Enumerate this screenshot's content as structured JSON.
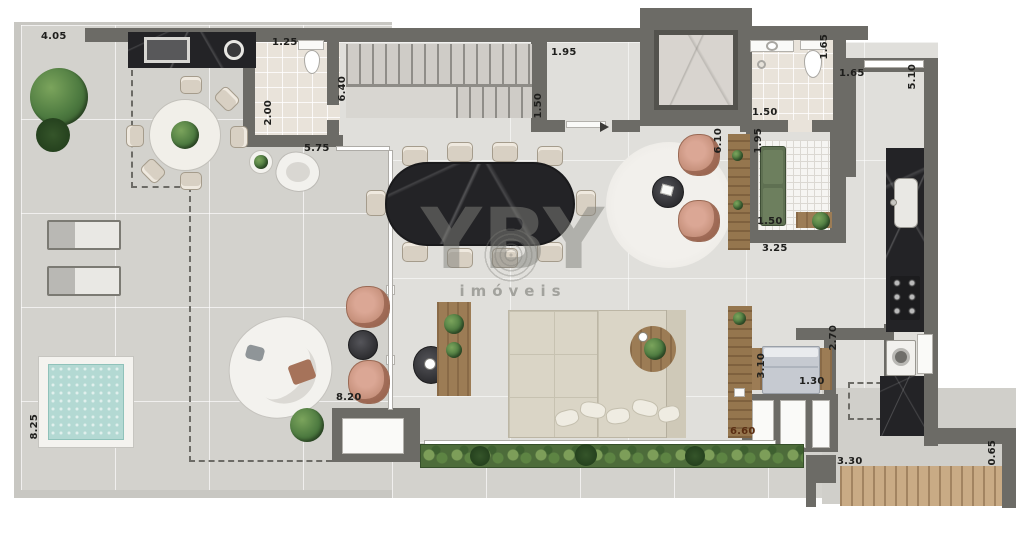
{
  "meta": {
    "type": "apartment-floor-plan"
  },
  "watermark": {
    "brand": "YBY",
    "tagline": "imóveis"
  },
  "dimensions": [
    "4.05",
    "1.25",
    "6.40",
    "2.00",
    "5.75",
    "1.95",
    "1.50",
    "1.65",
    "1.65",
    "5.10",
    "1.50",
    "6.10",
    "1.95",
    "1.50",
    "3.25",
    "3.10",
    "1.30",
    "2.70",
    "8.20",
    "6.60",
    "8.25",
    "3.30",
    "0.65"
  ],
  "palette": {
    "wall": "#6c6b66",
    "terrace_floor": "#d3d2cd",
    "interior_floor": "#e0dfdb",
    "bath_tile": "#e9e3da",
    "marble_dark": "#232326",
    "wood": "#95764e",
    "pool_water": "#b3d9d3",
    "hedge_green": "#4d6c3a",
    "accent_chair": "#c08a74",
    "sofa_beige": "#dad5c6",
    "watermark_gray": "#82827c"
  }
}
